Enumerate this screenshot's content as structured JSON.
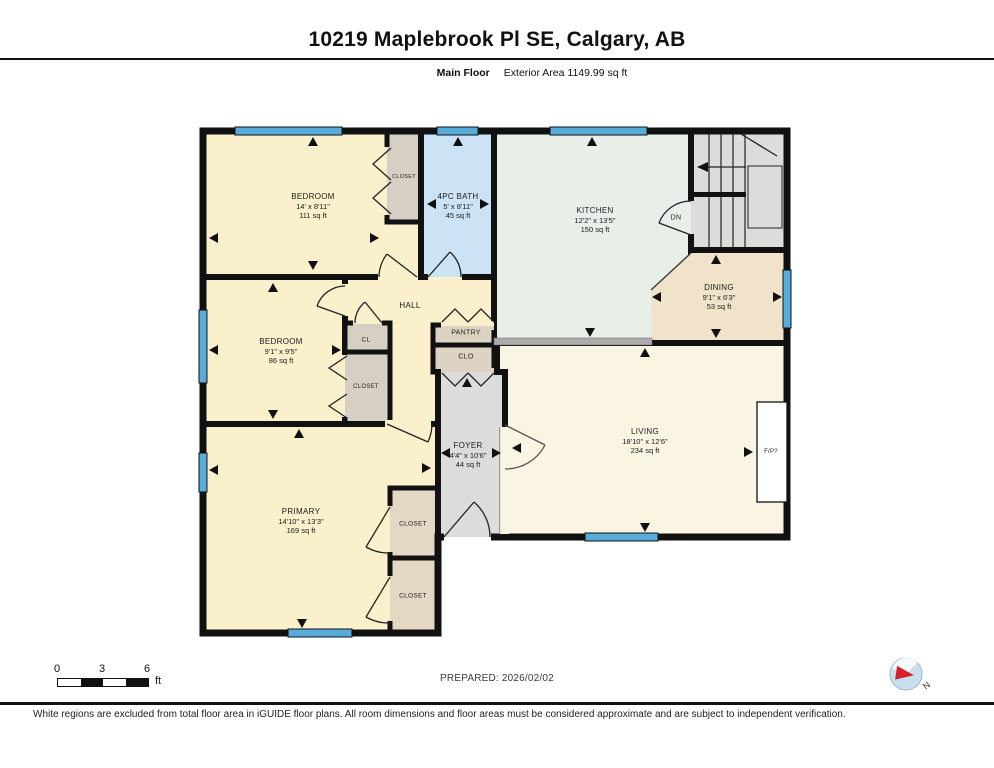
{
  "header": {
    "title": "10219 Maplebrook Pl SE, Calgary, AB",
    "floor_label": "Main Floor",
    "area_label": "Exterior Area 1149.99 sq ft"
  },
  "rooms": {
    "bedroom1": {
      "name": "BEDROOM",
      "dims": "14' x 8'11\"",
      "area": "111 sq ft"
    },
    "bath": {
      "name": "4PC BATH",
      "dims": "5' x 8'11\"",
      "area": "45 sq ft"
    },
    "kitchen": {
      "name": "KITCHEN",
      "dims": "12'2\" x 13'5\"",
      "area": "150 sq ft"
    },
    "dining": {
      "name": "DINING",
      "dims": "9'1\" x 6'3\"",
      "area": "53 sq ft"
    },
    "bedroom2": {
      "name": "BEDROOM",
      "dims": "9'1\" x 9'5\"",
      "area": "86 sq ft"
    },
    "hall": {
      "name": "HALL"
    },
    "foyer": {
      "name": "FOYER",
      "dims": "4'4\" x 10'6\"",
      "area": "44 sq ft"
    },
    "living": {
      "name": "LIVING",
      "dims": "18'10\" x 12'6\"",
      "area": "234 sq ft"
    },
    "primary": {
      "name": "PRIMARY",
      "dims": "14'10\" x 13'3\"",
      "area": "169 sq ft"
    }
  },
  "labels": {
    "closet": "CLOSET",
    "cl": "CL",
    "clo": "CLO",
    "pantry": "PANTRY",
    "dn": "DN",
    "fp": "F/P?",
    "north": "N"
  },
  "scale_bar": {
    "tick0": "0",
    "tick1": "3",
    "tick2": "6",
    "unit": "ft"
  },
  "footer": {
    "prepared": "PREPARED: 2026/02/02",
    "disclaimer": "White regions are excluded from total floor area in iGUIDE floor plans. All room dimensions and floor areas must be considered approximate and are subject to independent verification."
  },
  "colors": {
    "wall": "#111111",
    "window": "#57ACD9",
    "bedroom": "#FAF0CC",
    "living": "#FAF5E2",
    "dining": "#F1E3CA",
    "kitchen": "#E7EFE8",
    "bath": "#CBE3F5",
    "closet": "#D6D0C4",
    "closet_tan": "#E3D8C3",
    "pantry": "#DCD3C2",
    "gray": "#DCDCDA",
    "railing": "#ABABAB",
    "compass_red": "#D61F26"
  }
}
